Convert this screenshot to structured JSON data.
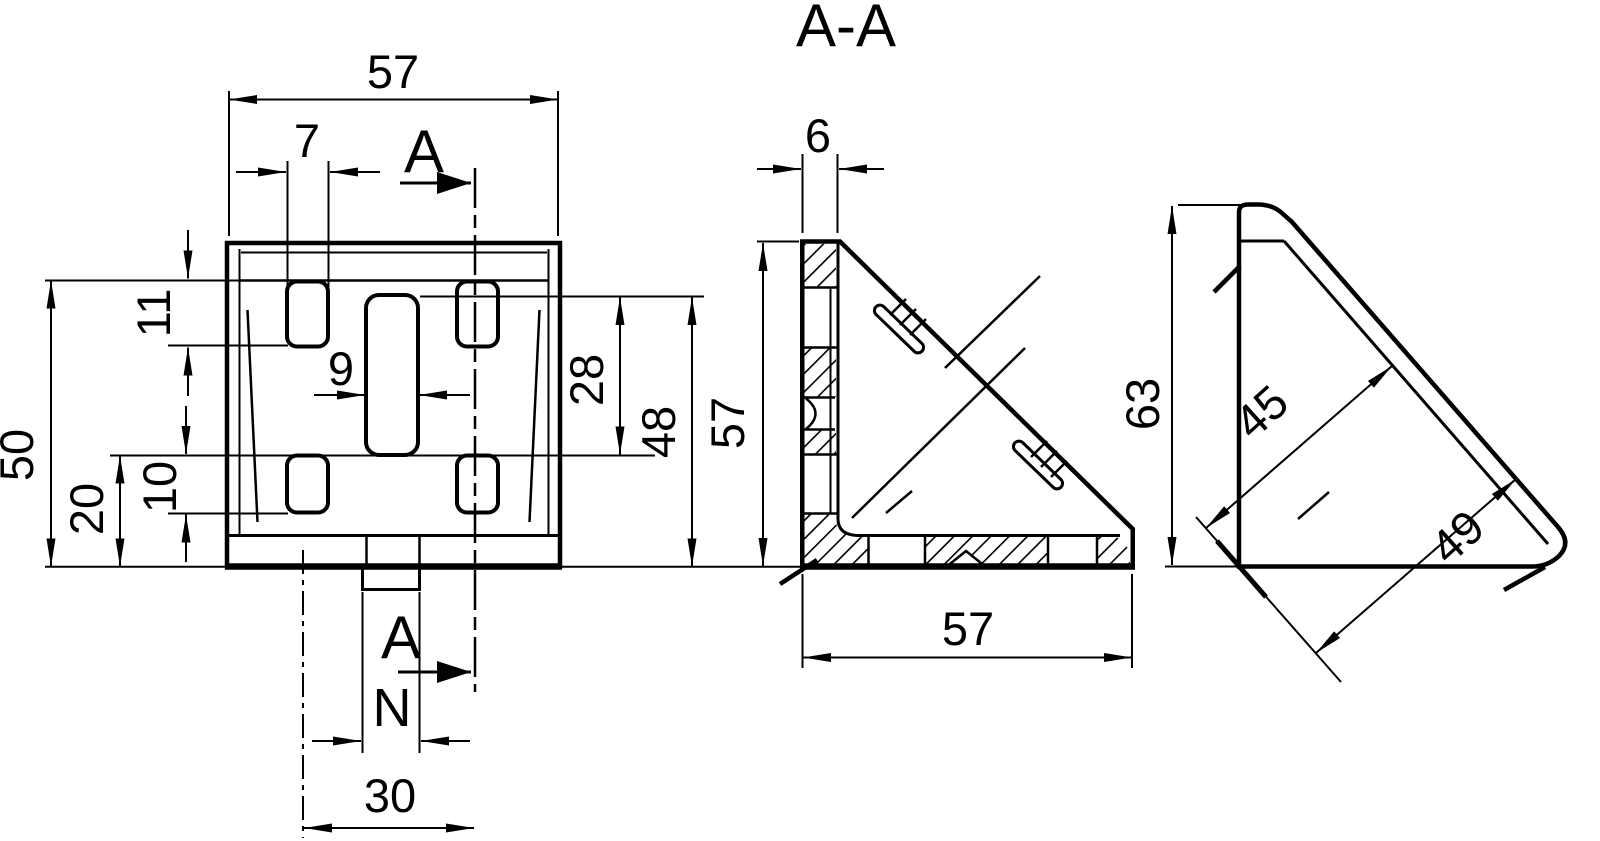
{
  "title": "A-A",
  "front_view": {
    "overall_width": "57",
    "top_slot_width": "7",
    "top_slot_height": "11",
    "height_to_slot_top": "50",
    "bottom_slot_zone_height": "20",
    "bottom_slot_height": "10",
    "center_slot_width": "9",
    "center_slot_height": "28",
    "center_slot_to_base": "48",
    "section_plane_offset": "30",
    "nut_marker": "N",
    "section_letter": "A"
  },
  "section_view": {
    "wall_thickness": "6",
    "height": "57",
    "width": "57"
  },
  "side_view": {
    "height": "63",
    "inner_diagonal_length": "45",
    "outer_diagonal_length": "49"
  }
}
